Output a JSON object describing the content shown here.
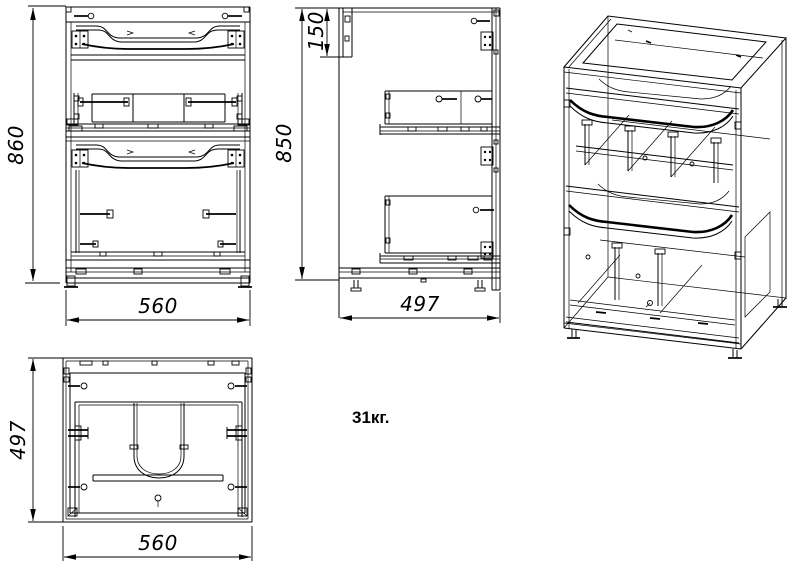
{
  "colors": {
    "background": "#ffffff",
    "ink": "#000000"
  },
  "dimensions": {
    "front_view": {
      "height": "860",
      "width": "560"
    },
    "side_view": {
      "top_recess": "150",
      "height": "850",
      "depth": "497"
    },
    "top_view": {
      "depth": "497",
      "width": "560"
    }
  },
  "weight": "31кг."
}
